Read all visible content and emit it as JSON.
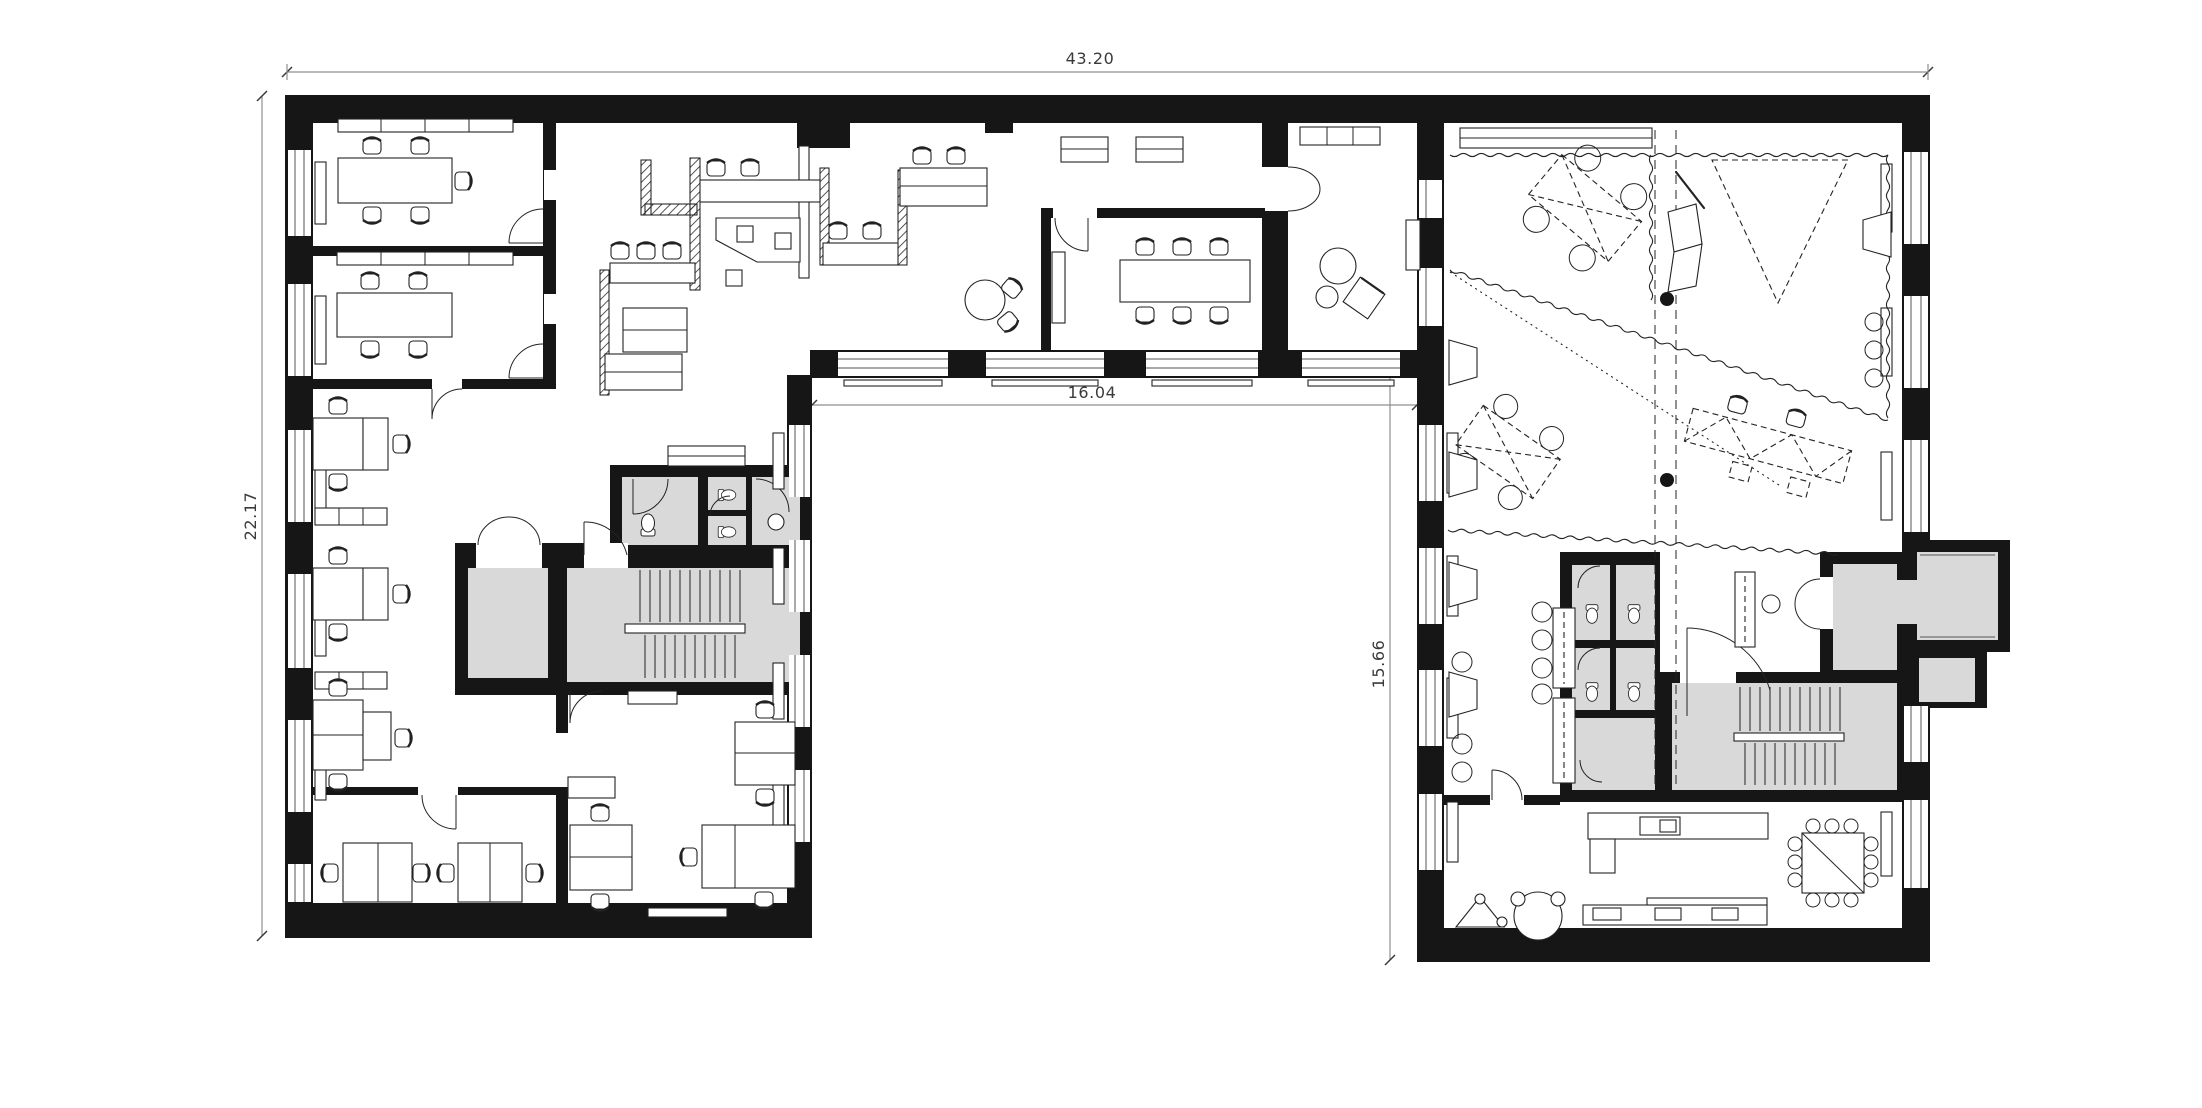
{
  "dimensions": {
    "overall_width": "43.20",
    "left_wing_height": "22.17",
    "courtyard_width": "16.04",
    "courtyard_height": "15.66"
  },
  "colors": {
    "background": "#ffffff",
    "wall_fill": "#161616",
    "service_room_fill": "#d9d9d9",
    "line_color": "#232323",
    "dimension_line_color": "#8f8f8f",
    "dimension_text_color": "#3a3a3a"
  }
}
